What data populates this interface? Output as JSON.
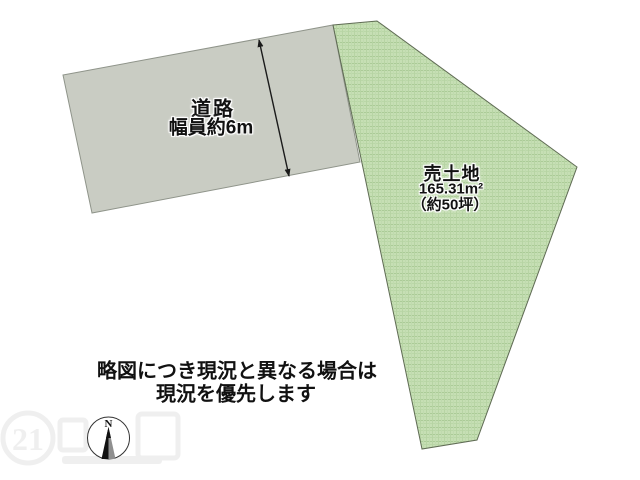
{
  "diagram": {
    "title": "土地区画略図",
    "road": {
      "name_label": "道路",
      "width_label": "幅員約6m"
    },
    "land": {
      "title_label": "売土地",
      "area_label": "165.31m²",
      "tsubo_label": "（約50坪）"
    },
    "note": {
      "line1": "略図につき現況と異なる場合は",
      "line2": "現況を優先します"
    },
    "compass": {
      "north_label": "N"
    },
    "watermark": {
      "number": "21"
    },
    "colors": {
      "road_fill": "#c9ccc3",
      "road_stroke": "#8f948a",
      "land_base": "#c6dfb4",
      "land_weave_dark": "#abcb97",
      "land_weave_mid": "#bad7a7",
      "land_stroke": "#5f6b54",
      "arrow_color": "#1a1a1a",
      "text_color": "#111111"
    }
  }
}
